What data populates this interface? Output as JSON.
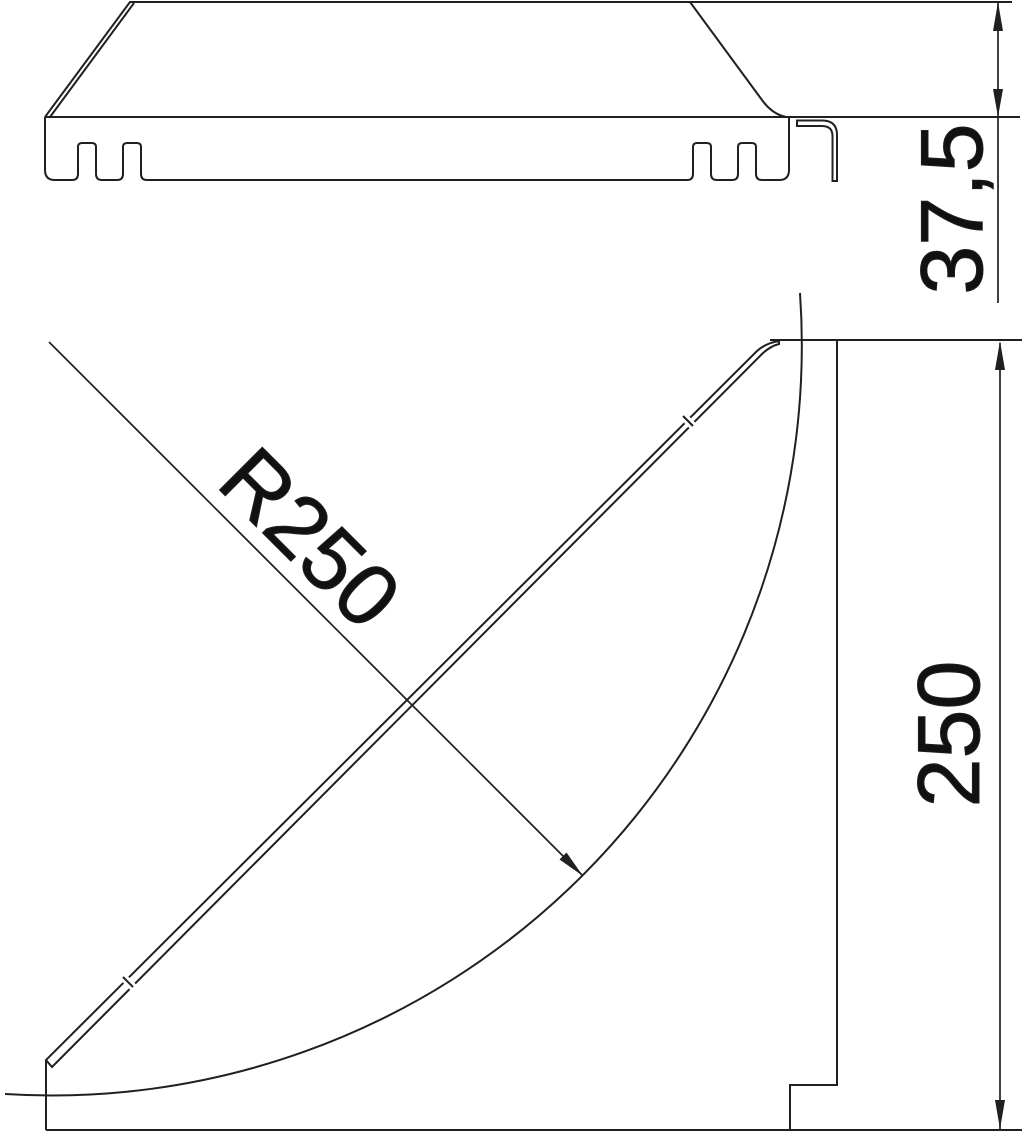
{
  "drawing": {
    "background_color": "#ffffff",
    "line_color": "#202020",
    "text_color": "#111111",
    "views": {
      "section": {
        "height_dimension_label": "37,5"
      },
      "plan": {
        "radius_dimension_label": "R250",
        "depth_dimension_label": "250"
      }
    }
  }
}
